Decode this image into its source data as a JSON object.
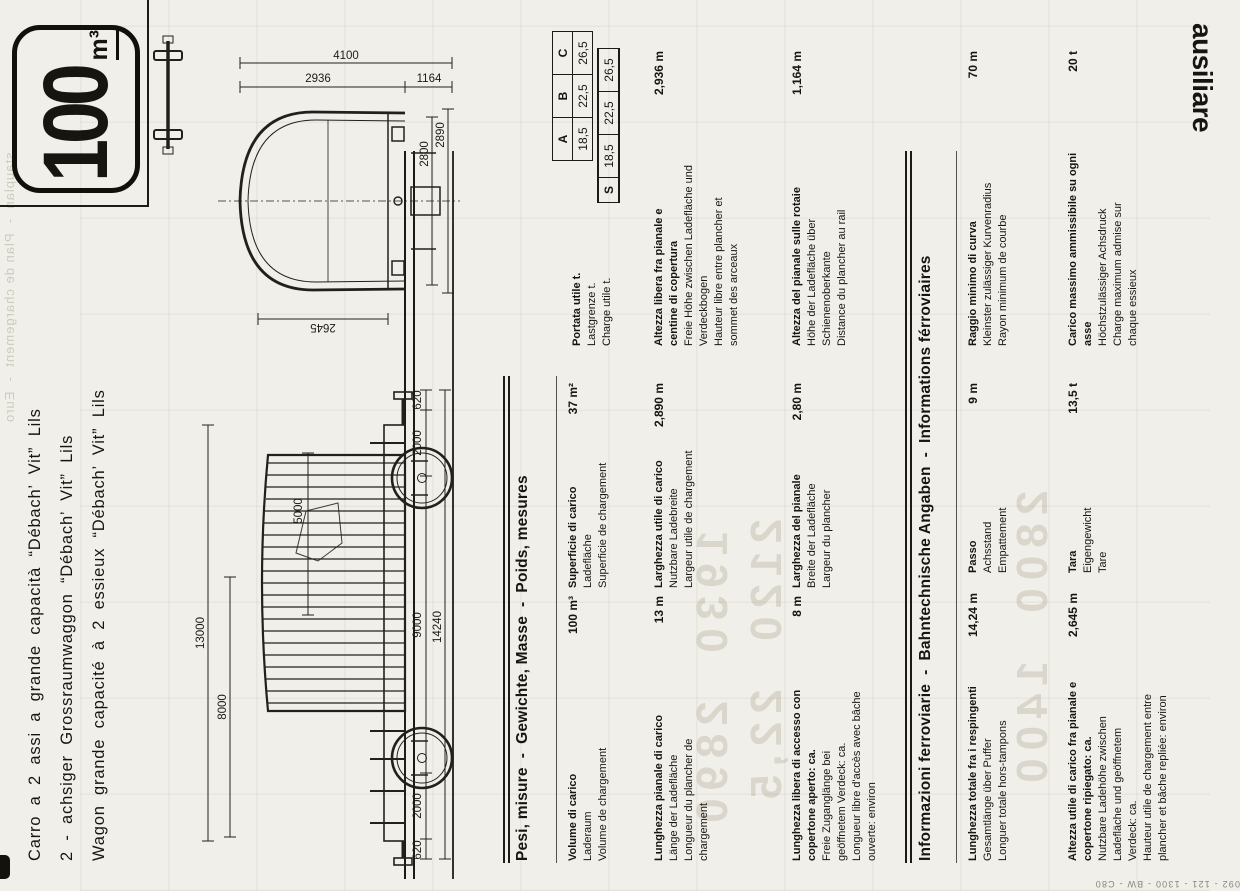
{
  "badge": {
    "number": "100",
    "unit": "m³"
  },
  "titles": [
    "Carro a 2 assi a grande capacità “Débach’ Vit” Lils",
    "2 - achsiger Grossraumwaggon “Débach’ Vit” Lils",
    "Wagon grande capacité à 2 essieux “Débach’ Vit” Lils"
  ],
  "side_tab": "ausiliare",
  "print_code": "092 - 121 - 1300 - BW - C80",
  "drawing_dims": {
    "side_view": {
      "len_body": "13000",
      "len_open": "8000",
      "len_hood": "5000",
      "chain": [
        "620",
        "2000",
        "9000",
        "2000",
        "620"
      ],
      "len_overall": "14240"
    },
    "end_view": {
      "h_total": "4100",
      "h_upper": "2936",
      "h_floor": "1164",
      "h_clear": "2645",
      "w_floor": "2800",
      "w_overall": "2890"
    }
  },
  "load_table": {
    "cols": [
      "A",
      "B",
      "C"
    ],
    "values": [
      "18,5",
      "22,5",
      "26,5"
    ],
    "s_label": "S",
    "s_values": [
      "18,5",
      "22,5",
      "26,5"
    ]
  },
  "sections": [
    {
      "title": "Pesi, misure  -  Gewichte, Masse  -  Poids, mesures",
      "entries": [
        {
          "it": "Volume di carico",
          "de": "Laderaum",
          "fr": "Volume de chargement",
          "value": "100 m³"
        },
        {
          "it": "Superficie di carico",
          "de": "Ladefläche",
          "fr": "Superficie de chargement",
          "value": "37 m²"
        },
        {
          "it": "Portata utile t.",
          "de": "Lastgrenze t.",
          "fr": "Charge utile t.",
          "value": ""
        },
        {
          "it": "Lunghezza pianale di carico",
          "de": "Länge der Ladefläche",
          "fr": "Longueur du plancher de chargement",
          "value": "13 m"
        },
        {
          "it": "Larghezza utile di carico",
          "de": "Nutzbare Ladebreite",
          "fr": "Largeur utile de chargement",
          "value": "2,890 m"
        },
        {
          "it": "Altezza libera fra pianale e centine di copertura",
          "de": "Freie Höhe zwischen Ladefläche und Verdeckbogen",
          "fr": "Hauteur libre entre plancher et sommet des arceaux",
          "value": "2,936 m"
        },
        {
          "it": "Lunghezza libera di accesso con copertone aperto: ca.",
          "de": "Freie Zuganglänge bei geöffnetem Verdeck: ca.",
          "fr": "Longueur libre d'accès avec bâche ouverte: environ",
          "value": "8 m"
        },
        {
          "it": "Larghezza del pianale",
          "de": "Breite der Ladefläche",
          "fr": "Largeur du plancher",
          "value": "2,80 m"
        },
        {
          "it": "Altezza del pianale sulle rotaie",
          "de": "Höhe der Ladefläche über Schienenoberkante",
          "fr": "Distance du plancher au rail",
          "value": "1,164 m"
        }
      ]
    },
    {
      "title": "Informazioni ferroviarie  -  Bahntechnische Angaben  -  Informations férroviaires",
      "entries": [
        {
          "it": "Lunghezza totale fra i respingenti",
          "de": "Gesamtlänge über Puffer",
          "fr": "Longuer totale hors-tampons",
          "value": "14,24 m"
        },
        {
          "it": "Passo",
          "de": "Achsstand",
          "fr": "Empattement",
          "value": "9 m"
        },
        {
          "it": "Raggio minimo di curva",
          "de": "Kleinster zulässiger Kurvenradius",
          "fr": "Rayon minimum de courbe",
          "value": "70 m"
        },
        {
          "it": "Altezza utile di carico fra pianale e copertone ripiegato: ca.",
          "de": "Nutzbare Ladehöhe zwischen Ladefläche und geöffnetem Verdeck: ca.",
          "fr": "Hauteur utile de chargement entre plancher et bâche repliée: environ",
          "value": "2,645 m"
        },
        {
          "it": "Tara",
          "de": "Eigengewicht",
          "fr": "Tare",
          "value": "13,5 t"
        },
        {
          "it": "Carico massimo ammissibile su ogni asse",
          "de": "Höchstzulässiger Achsdruck",
          "fr": "Charge maximum admise sur chaque essieux",
          "value": "20 t"
        }
      ]
    }
  ],
  "bleedthrough": {
    "edge_text": "stauplan  -  Plan de chargement  -  Euro",
    "numbers_1": "1930  2890",
    "numbers_2": "2120  22,5",
    "numbers_3": "2800  1400"
  }
}
